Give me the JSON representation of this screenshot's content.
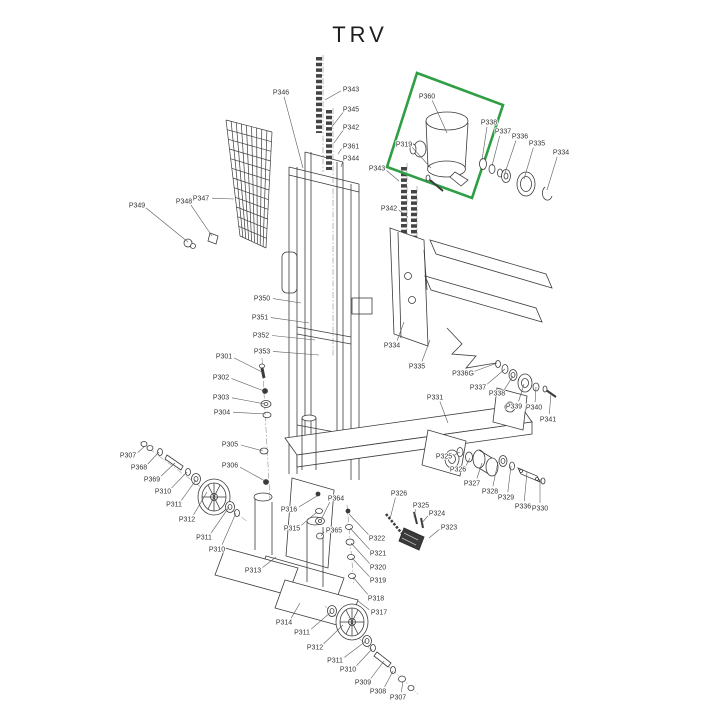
{
  "title": "TRV",
  "colors": {
    "highlight": "#2f9e44",
    "line": "#3c3c3c",
    "label_text": "#333333"
  },
  "highlight_box": {
    "points": "417,73 503,105 472,198 387,167"
  },
  "labels": [
    {
      "text": "P346",
      "x": 281,
      "y": 92,
      "tx": 303,
      "ty": 168
    },
    {
      "text": "P343",
      "x": 351,
      "y": 89,
      "tx": 325,
      "ty": 100
    },
    {
      "text": "P345",
      "x": 351,
      "y": 109,
      "tx": 331,
      "ty": 128
    },
    {
      "text": "P342",
      "x": 351,
      "y": 127,
      "tx": 334,
      "ty": 143
    },
    {
      "text": "P361",
      "x": 351,
      "y": 146,
      "tx": 338,
      "ty": 154
    },
    {
      "text": "P344",
      "x": 351,
      "y": 158,
      "tx": 341,
      "ty": 167
    },
    {
      "text": "P349",
      "x": 137,
      "y": 205,
      "tx": 188,
      "ty": 242
    },
    {
      "text": "P348",
      "x": 184,
      "y": 201,
      "tx": 212,
      "ty": 236
    },
    {
      "text": "P347",
      "x": 201,
      "y": 198,
      "tx": 234,
      "ty": 199
    },
    {
      "text": "P360",
      "x": 427,
      "y": 96,
      "tx": 447,
      "ty": 133
    },
    {
      "text": "P319",
      "x": 404,
      "y": 144,
      "tx": 431,
      "ty": 168
    },
    {
      "text": "P338",
      "x": 489,
      "y": 122,
      "tx": 482,
      "ty": 160
    },
    {
      "text": "P337",
      "x": 503,
      "y": 131,
      "tx": 492,
      "ty": 166
    },
    {
      "text": "P336",
      "x": 520,
      "y": 136,
      "tx": 505,
      "ty": 173
    },
    {
      "text": "P335",
      "x": 537,
      "y": 143,
      "tx": 524,
      "ty": 179
    },
    {
      "text": "P334",
      "x": 561,
      "y": 152,
      "tx": 547,
      "ty": 190
    },
    {
      "text": "P343",
      "x": 377,
      "y": 168,
      "tx": 399,
      "ty": 181
    },
    {
      "text": "P342",
      "x": 389,
      "y": 208,
      "tx": 408,
      "ty": 217
    },
    {
      "text": "P350",
      "x": 262,
      "y": 298,
      "tx": 301,
      "ty": 303
    },
    {
      "text": "P351",
      "x": 260,
      "y": 317,
      "tx": 309,
      "ty": 323
    },
    {
      "text": "P352",
      "x": 261,
      "y": 335,
      "tx": 315,
      "ty": 340
    },
    {
      "text": "P353",
      "x": 262,
      "y": 351,
      "tx": 319,
      "ty": 355
    },
    {
      "text": "P334",
      "x": 392,
      "y": 345,
      "tx": 404,
      "ty": 322
    },
    {
      "text": "P335",
      "x": 417,
      "y": 366,
      "tx": 430,
      "ty": 340
    },
    {
      "text": "P336G",
      "x": 463,
      "y": 373,
      "tx": 497,
      "ty": 363
    },
    {
      "text": "P337",
      "x": 478,
      "y": 387,
      "tx": 505,
      "ty": 369
    },
    {
      "text": "P338",
      "x": 497,
      "y": 393,
      "tx": 513,
      "ty": 376
    },
    {
      "text": "P339",
      "x": 514,
      "y": 406,
      "tx": 524,
      "ty": 384
    },
    {
      "text": "P340",
      "x": 534,
      "y": 407,
      "tx": 536,
      "ty": 387
    },
    {
      "text": "P341",
      "x": 548,
      "y": 419,
      "tx": 551,
      "ty": 394
    },
    {
      "text": "P331",
      "x": 435,
      "y": 397,
      "tx": 448,
      "ty": 423
    },
    {
      "text": "P301",
      "x": 224,
      "y": 356,
      "tx": 262,
      "ty": 372
    },
    {
      "text": "P302",
      "x": 221,
      "y": 377,
      "tx": 264,
      "ty": 391
    },
    {
      "text": "P303",
      "x": 221,
      "y": 397,
      "tx": 265,
      "ty": 404
    },
    {
      "text": "P304",
      "x": 222,
      "y": 412,
      "tx": 266,
      "ty": 414
    },
    {
      "text": "P305",
      "x": 230,
      "y": 444,
      "tx": 263,
      "ty": 451
    },
    {
      "text": "P306",
      "x": 230,
      "y": 465,
      "tx": 265,
      "ty": 481
    },
    {
      "text": "P307",
      "x": 128,
      "y": 455,
      "tx": 145,
      "ty": 446
    },
    {
      "text": "P368",
      "x": 139,
      "y": 467,
      "tx": 159,
      "ty": 452
    },
    {
      "text": "P369",
      "x": 152,
      "y": 479,
      "tx": 175,
      "ty": 463
    },
    {
      "text": "P310",
      "x": 163,
      "y": 491,
      "tx": 187,
      "ty": 472
    },
    {
      "text": "P311",
      "x": 174,
      "y": 504,
      "tx": 196,
      "ty": 480
    },
    {
      "text": "P312",
      "x": 187,
      "y": 519,
      "tx": 207,
      "ty": 492
    },
    {
      "text": "P311",
      "x": 204,
      "y": 537,
      "tx": 229,
      "ty": 507
    },
    {
      "text": "P310",
      "x": 217,
      "y": 549,
      "tx": 236,
      "ty": 513
    },
    {
      "text": "P313",
      "x": 253,
      "y": 570,
      "tx": 276,
      "ty": 557
    },
    {
      "text": "P316",
      "x": 289,
      "y": 509,
      "tx": 317,
      "ty": 496
    },
    {
      "text": "P315",
      "x": 292,
      "y": 528,
      "tx": 317,
      "ty": 512
    },
    {
      "text": "P364",
      "x": 336,
      "y": 498,
      "tx": 321,
      "ty": 520
    },
    {
      "text": "P365",
      "x": 334,
      "y": 530,
      "tx": 321,
      "ty": 536
    },
    {
      "text": "P322",
      "x": 377,
      "y": 538,
      "tx": 349,
      "ty": 514
    },
    {
      "text": "P321",
      "x": 378,
      "y": 553,
      "tx": 350,
      "ty": 528
    },
    {
      "text": "P320",
      "x": 378,
      "y": 567,
      "tx": 351,
      "ty": 543
    },
    {
      "text": "P319",
      "x": 378,
      "y": 580,
      "tx": 352,
      "ty": 558
    },
    {
      "text": "P318",
      "x": 376,
      "y": 598,
      "tx": 353,
      "ty": 577
    },
    {
      "text": "P317",
      "x": 379,
      "y": 612,
      "tx": 358,
      "ty": 601
    },
    {
      "text": "P326",
      "x": 399,
      "y": 493,
      "tx": 390,
      "ty": 519
    },
    {
      "text": "P325",
      "x": 421,
      "y": 505,
      "tx": 414,
      "ty": 517
    },
    {
      "text": "P324",
      "x": 437,
      "y": 513,
      "tx": 421,
      "ty": 524
    },
    {
      "text": "P323",
      "x": 449,
      "y": 527,
      "tx": 429,
      "ty": 538
    },
    {
      "text": "P325",
      "x": 444,
      "y": 456,
      "tx": 460,
      "ty": 452
    },
    {
      "text": "P326",
      "x": 458,
      "y": 469,
      "tx": 470,
      "ty": 458
    },
    {
      "text": "P327",
      "x": 472,
      "y": 483,
      "tx": 482,
      "ty": 463
    },
    {
      "text": "P328",
      "x": 490,
      "y": 491,
      "tx": 498,
      "ty": 462
    },
    {
      "text": "P329",
      "x": 506,
      "y": 497,
      "tx": 511,
      "ty": 466
    },
    {
      "text": "P336",
      "x": 523,
      "y": 506,
      "tx": 527,
      "ty": 472
    },
    {
      "text": "P330",
      "x": 540,
      "y": 508,
      "tx": 540,
      "ty": 479
    },
    {
      "text": "P314",
      "x": 284,
      "y": 622,
      "tx": 300,
      "ty": 603
    },
    {
      "text": "P311",
      "x": 302,
      "y": 632,
      "tx": 331,
      "ty": 612
    },
    {
      "text": "P312",
      "x": 315,
      "y": 647,
      "tx": 343,
      "ty": 625
    },
    {
      "text": "P311",
      "x": 335,
      "y": 660,
      "tx": 366,
      "ty": 641
    },
    {
      "text": "P310",
      "x": 348,
      "y": 669,
      "tx": 372,
      "ty": 649
    },
    {
      "text": "P309",
      "x": 363,
      "y": 682,
      "tx": 384,
      "ty": 661
    },
    {
      "text": "P308",
      "x": 378,
      "y": 691,
      "tx": 393,
      "ty": 671
    },
    {
      "text": "P307",
      "x": 398,
      "y": 697,
      "tx": 403,
      "ty": 681
    }
  ]
}
